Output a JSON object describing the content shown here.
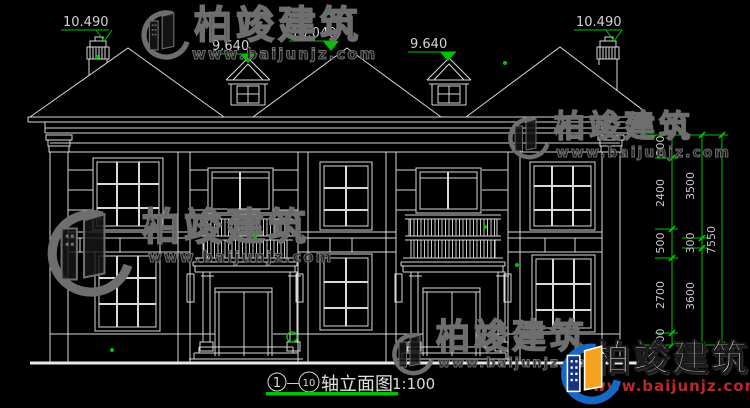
{
  "drawing": {
    "elevations": {
      "left_chimney": "10.490",
      "left_dormer": "9.640",
      "center_ridge": "10.040",
      "right_dormer": "9.640",
      "right_chimney": "10.490"
    },
    "dims_inner": [
      "800",
      "2400",
      "500",
      "2700",
      "400"
    ],
    "dims_middle": [
      "3500",
      "300",
      "3600"
    ],
    "dims_outer": [
      "7550"
    ],
    "title": {
      "axis_from": "1",
      "separator": "—",
      "axis_to": "10",
      "name": "轴立面图",
      "scale": "1:100"
    }
  },
  "watermark": {
    "brand": "柏竣建筑",
    "url": "www.baijunjz.com"
  },
  "colors": {
    "background": "#000000",
    "line": "#d9d9d9",
    "dimension_green": "#00c400",
    "dim_text": "#c8c8c8",
    "logo_blue": "#1668c4",
    "logo_dark_blue": "#16337f",
    "logo_orange": "#f7a21f",
    "logo_red": "#b52a2a"
  }
}
